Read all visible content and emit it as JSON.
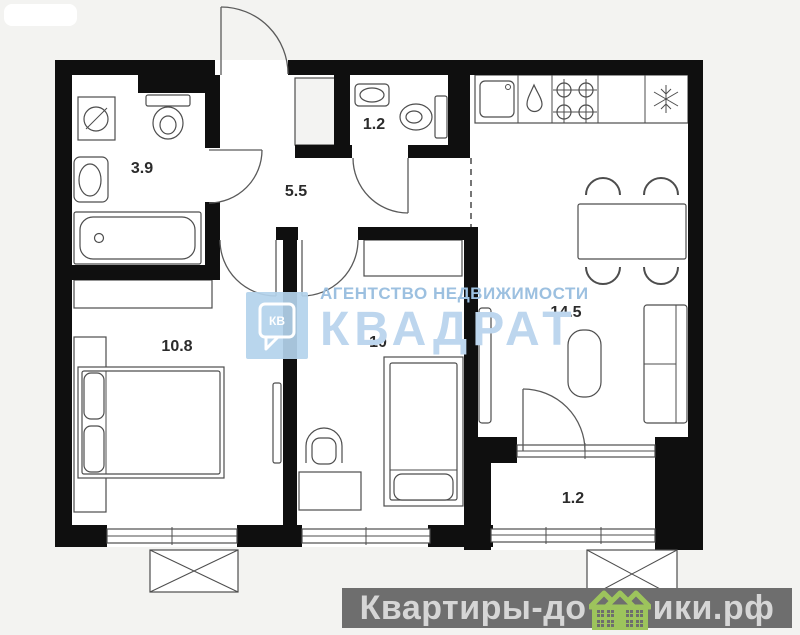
{
  "page": {
    "background_color": "#f3f3f1",
    "wall_color": "#0f0f0f"
  },
  "plan": {
    "type": "apartment-floor-plan",
    "rooms": [
      {
        "id": "bathroom",
        "area_label": "3.9"
      },
      {
        "id": "toilet",
        "area_label": "1.2"
      },
      {
        "id": "hallway",
        "area_label": "5.5"
      },
      {
        "id": "bedroom-main",
        "area_label": "10.8"
      },
      {
        "id": "bedroom-second",
        "area_label": "10"
      },
      {
        "id": "kitchen-living",
        "area_label": "14.5"
      },
      {
        "id": "balcony",
        "area_label": "1.2"
      }
    ],
    "fixtures": [
      "washing-machine-icon",
      "toilet-icon",
      "wall-sink-icon",
      "bathtub-icon",
      "toilet-icon",
      "corner-sink-icon",
      "kitchen-sink-icon",
      "water-drop-icon",
      "stove-four-burner-icon",
      "refrigerator-snowflake-icon",
      "dining-table",
      "dining-chairs",
      "sofa",
      "coffee-table",
      "double-bed",
      "single-bed",
      "wardrobe",
      "desk",
      "desk-chair",
      "window",
      "door-swing",
      "air-conditioner-box"
    ]
  },
  "watermark_center": {
    "agency_line": "АГЕНТСТВО НЕДВИЖИМОСТИ",
    "brand_line": "КВАДРАТ",
    "logo_text": "КВ",
    "text_color": "#9cc0e0",
    "brand_color": "#bdd6ee",
    "logo_bg": "#b3d2ec"
  },
  "watermark_bottom": {
    "text_before_icon": "Квартиры-до",
    "text_after_icon": "ики.рф",
    "bar_color": "#6e6e6e",
    "text_color": "#d6d6d6",
    "house_green": "#9dc45c"
  }
}
